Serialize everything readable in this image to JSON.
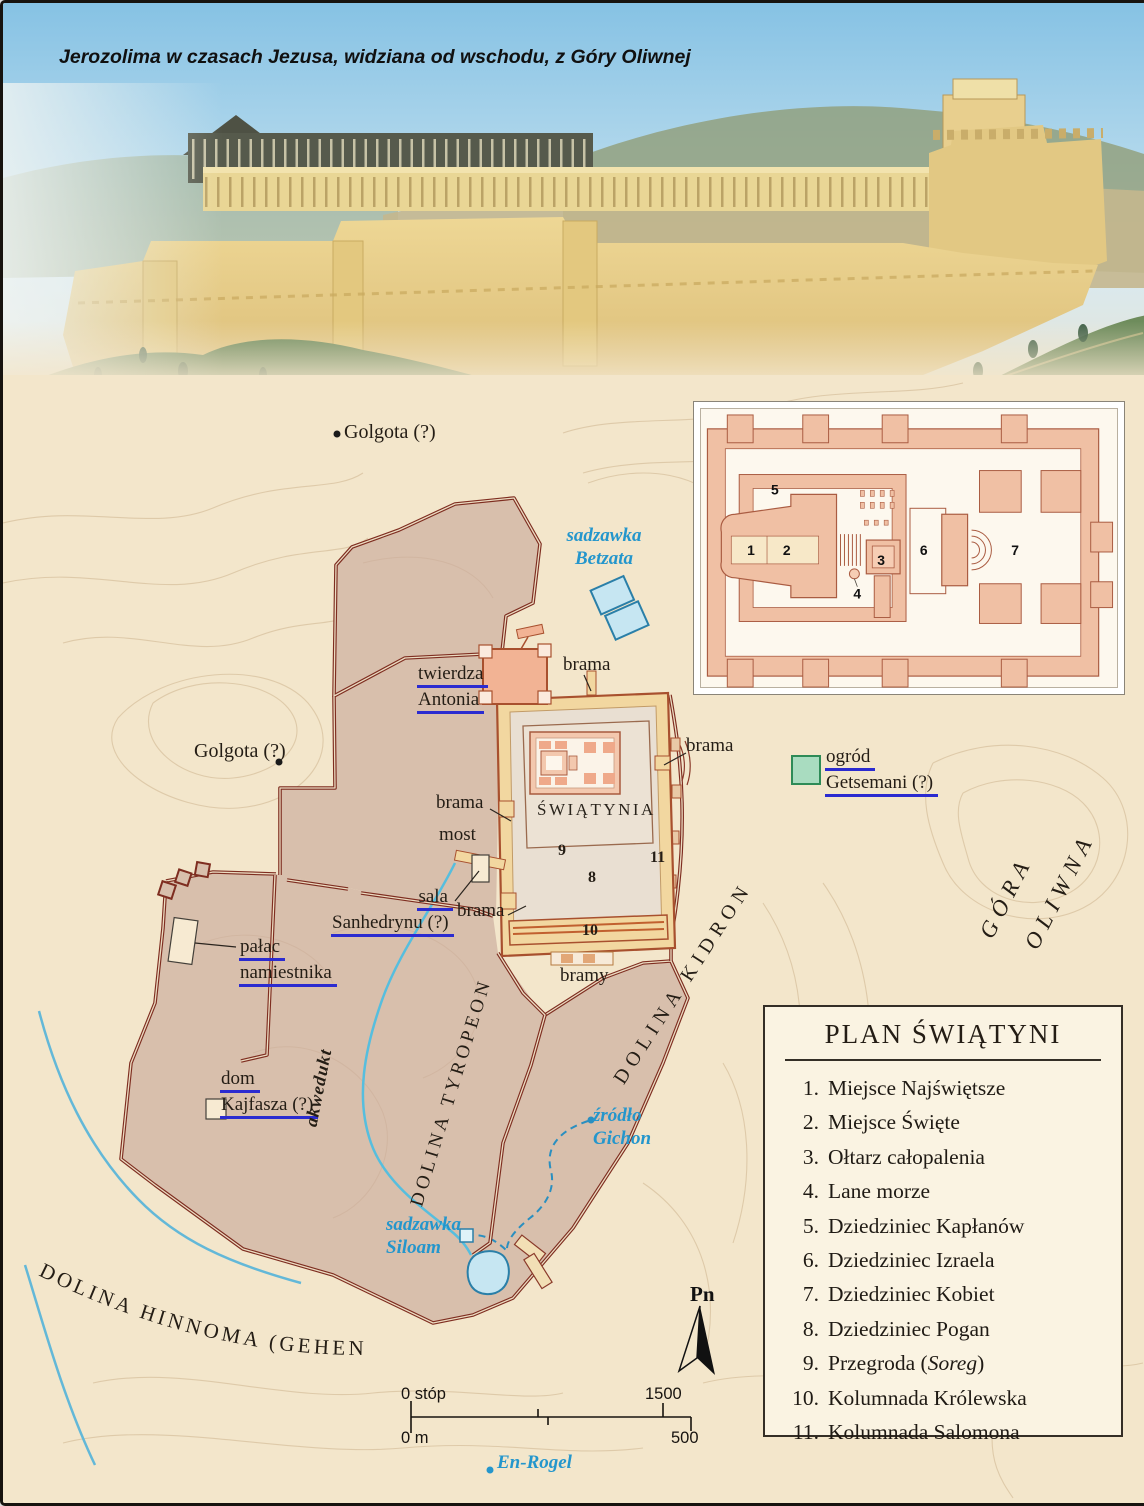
{
  "title": {
    "line1": "Jerozolima w czasach Jezusa,",
    "line2": "widziana od wschodu, z Góry Oliwnej"
  },
  "labels": {
    "golgota_top": "Golgota (?)",
    "golgota_left": "Golgota (?)",
    "betzata1": "sadzawka",
    "betzata2": "Betzata",
    "twierdza1": "twierdza",
    "twierdza2": "Antonia",
    "brama_top": "brama",
    "brama_right": "brama",
    "brama_left": "brama",
    "brama_lower": "brama",
    "bramy": "bramy",
    "swiatynia": "ŚWIĄTYNIA",
    "most": "most",
    "sala1": "sala",
    "sala2": "Sanhedrynu (?)",
    "palac1": "pałac",
    "palac2": "namiestnika",
    "dom1": "dom",
    "dom2": "Kajfasza (?)",
    "ogrod1": "ogród",
    "ogrod2": "Getsemani (?)",
    "gora1": "GÓRA",
    "gora2": "OLIWNA",
    "dolina_kidron": "DOLINA KIDRON",
    "dolina_tyropeon": "DOLINA TYROPEON",
    "dolina_hinnoma": "DOLINA HINNOMA (GEHENNA)",
    "akwedukt": "akwedukt",
    "zrodlo1": "źródło",
    "zrodlo2": "Gichon",
    "siloam1": "sadzawka",
    "siloam2": "Siloam",
    "enrogel": "En-Rogel"
  },
  "map_numbers": {
    "n8": "8",
    "n9": "9",
    "n10": "10",
    "n11": "11"
  },
  "inset_numbers": [
    "1",
    "2",
    "3",
    "4",
    "5",
    "6",
    "7"
  ],
  "legend": {
    "title": "PLAN ŚWIĄTYNI",
    "items": [
      {
        "num": "1.",
        "pre": "Miejsce Najświętsze",
        "italic": "",
        "post": ""
      },
      {
        "num": "2.",
        "pre": "Miejsce Święte",
        "italic": "",
        "post": ""
      },
      {
        "num": "3.",
        "pre": "Ołtarz całopalenia",
        "italic": "",
        "post": ""
      },
      {
        "num": "4.",
        "pre": "Lane morze",
        "italic": "",
        "post": ""
      },
      {
        "num": "5.",
        "pre": "Dziedziniec Kapłanów",
        "italic": "",
        "post": ""
      },
      {
        "num": "6.",
        "pre": "Dziedziniec Izraela",
        "italic": "",
        "post": ""
      },
      {
        "num": "7.",
        "pre": "Dziedziniec Kobiet",
        "italic": "",
        "post": ""
      },
      {
        "num": "8.",
        "pre": "Dziedziniec Pogan",
        "italic": "",
        "post": ""
      },
      {
        "num": "9.",
        "pre": "Przegroda (",
        "italic": "Soreg",
        "post": ")"
      },
      {
        "num": "10.",
        "pre": "Kolumnada Królewska",
        "italic": "",
        "post": ""
      },
      {
        "num": "11.",
        "pre": "Kolumnada Salomona",
        "italic": "",
        "post": ""
      }
    ]
  },
  "compass": {
    "label": "Pn"
  },
  "scale": {
    "feet0": "0 stóp",
    "feet1": "1500",
    "m0": "0 m",
    "m1": "500"
  },
  "colors": {
    "water": "#2496cc",
    "link_underline": "#2b2bd0",
    "wall": "#7e2d20",
    "city_fill": "#d8bfac",
    "temple_wall": "#f2d7a0",
    "pool_fill": "#c6e6f2",
    "getsemani_fill": "#a9dcc0",
    "map_background": "#f3e6cb"
  }
}
